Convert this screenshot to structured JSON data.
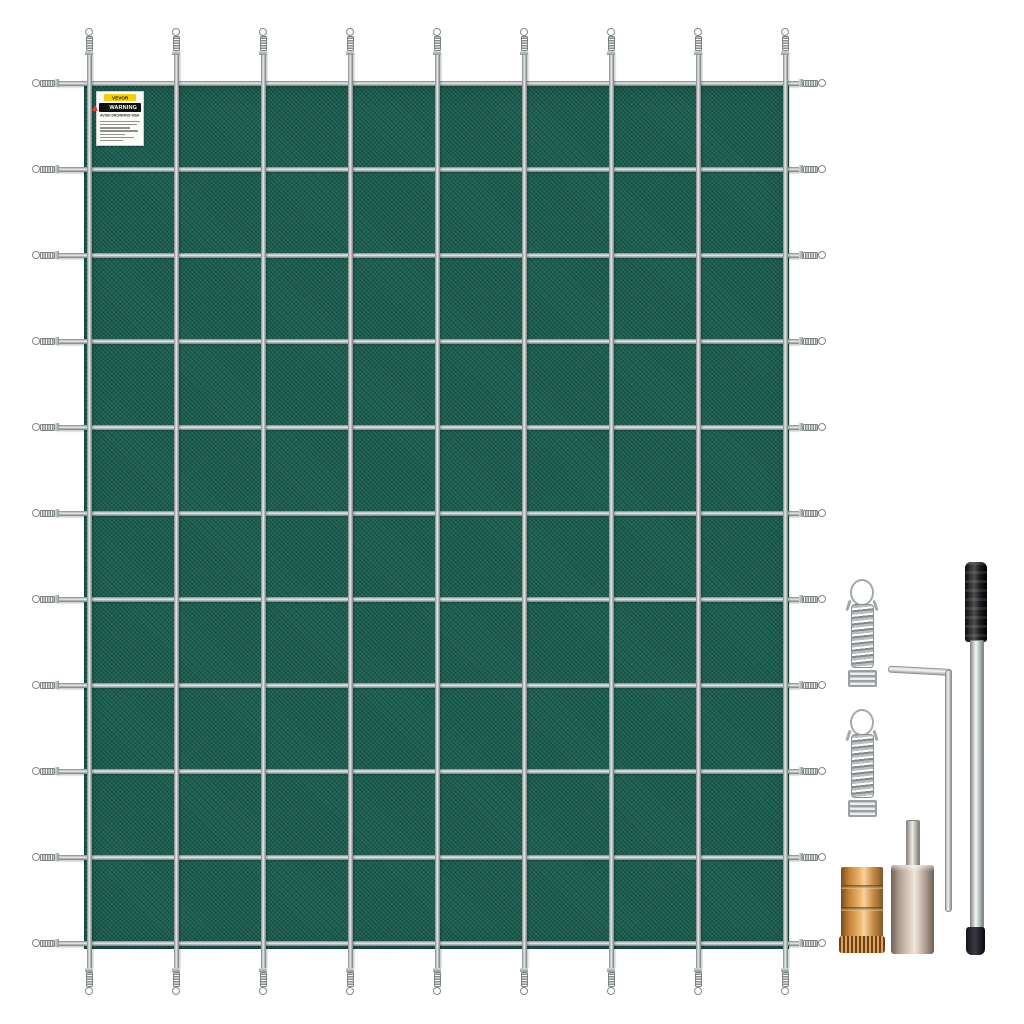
{
  "label": {
    "brand": "VEVOR",
    "warning_word": "WARNING",
    "heading": "AVOID DROWNING RISK",
    "fine_print_line_widths": [
      95,
      88,
      72,
      90,
      60,
      80,
      55
    ],
    "box": {
      "left": 96,
      "top": 91,
      "width": 48,
      "height": 55
    }
  },
  "cover": {
    "left": 84,
    "top": 85,
    "width": 705,
    "height": 864,
    "strap_thickness": 5,
    "vertical_straps_x": [
      89,
      176,
      263,
      350,
      437,
      524,
      611,
      698,
      785
    ],
    "horizontal_straps_y": [
      83,
      169,
      255,
      341,
      427,
      513,
      599,
      685,
      771,
      857,
      943
    ],
    "v_strap_top": 52,
    "v_strap_bottom": 968,
    "h_strap_left": 56,
    "h_strap_right": 800,
    "tip_top_y": 26,
    "tip_bottom_y": 966,
    "tip_left_x": 30,
    "tip_right_x": 797
  },
  "colors": {
    "mesh_green": "#1e6153",
    "mesh_edge": "#14443a",
    "strap_gray": "#c2c7c8",
    "label_yellow": "#f4cd0c",
    "warning_red": "#e8392e",
    "brass": "#edb66d",
    "nickel": "#e2d4c8",
    "steel": "#f0f2f2",
    "handle_black": "#1a1a1e",
    "background": "#ffffff"
  },
  "kit": {
    "springs": [
      {
        "left": 843,
        "top": 579
      },
      {
        "left": 843,
        "top": 709
      }
    ],
    "hex_key": {
      "arm_left": 888,
      "arm_top": 669,
      "arm_width": 62,
      "leg_left": 945,
      "leg_top": 670,
      "leg_height": 240
    },
    "installation_rod": {
      "handle": {
        "left": 965,
        "top": 562,
        "width": 22,
        "height": 80
      },
      "shaft": {
        "left": 970,
        "top": 640,
        "width": 12,
        "height": 290
      },
      "tip": {
        "left": 966,
        "top": 927,
        "width": 19,
        "height": 28
      }
    },
    "brass_anchor": {
      "left": 841,
      "top": 867,
      "width": 42,
      "height": 72,
      "grooves_y": [
        18,
        40
      ],
      "knurl": {
        "left": 839,
        "top": 936,
        "width": 46,
        "height": 17
      }
    },
    "tamping_tool": {
      "pin": {
        "left": 906,
        "top": 820,
        "width": 12,
        "height": 48
      },
      "body": {
        "left": 891,
        "top": 865,
        "width": 43,
        "height": 89
      }
    }
  }
}
